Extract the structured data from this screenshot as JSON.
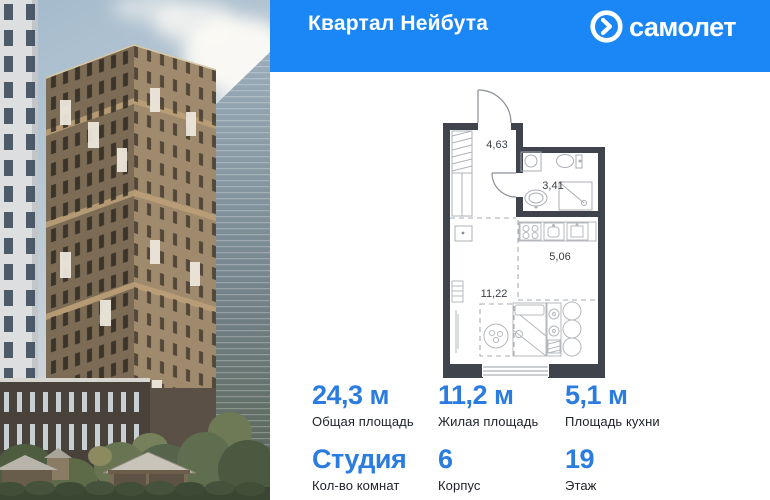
{
  "header": {
    "title": "Квартал Нейбута",
    "brand": "самолет",
    "accent_color": "#1b87f6"
  },
  "floorplan": {
    "wall_color": "#3f444c",
    "rooms": [
      {
        "name": "hallway",
        "area": "4,63"
      },
      {
        "name": "bathroom",
        "area": "3,41"
      },
      {
        "name": "kitchen",
        "area": "5,06"
      },
      {
        "name": "living",
        "area": "11,22"
      }
    ]
  },
  "stats": {
    "accent_color": "#2b7ce0",
    "row1": [
      {
        "value": "24,3 м",
        "label": "Общая площадь"
      },
      {
        "value": "11,2 м",
        "label": "Жилая площадь"
      },
      {
        "value": "5,1 м",
        "label": "Площадь кухни"
      }
    ],
    "row2": [
      {
        "value": "Студия",
        "label": "Кол-во комнат"
      },
      {
        "value": "6",
        "label": "Корпус"
      },
      {
        "value": "19",
        "label": "Этаж"
      }
    ]
  },
  "photo": {
    "description": "residential tower exterior render with playground"
  }
}
